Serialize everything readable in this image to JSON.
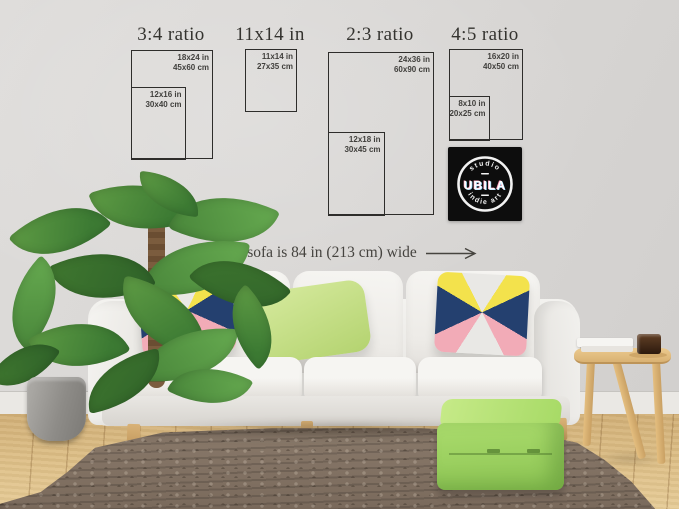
{
  "size_guide": {
    "sections": [
      {
        "title": "3:4 ratio",
        "frames": [
          {
            "size_in": "18x24 in",
            "size_cm": "45x60 cm"
          },
          {
            "size_in": "12x16 in",
            "size_cm": "30x40 cm"
          }
        ]
      },
      {
        "title": "11x14 in",
        "frames": [
          {
            "size_in": "11x14 in",
            "size_cm": "27x35 cm"
          }
        ]
      },
      {
        "title": "2:3 ratio",
        "frames": [
          {
            "size_in": "24x36 in",
            "size_cm": "60x90 cm"
          },
          {
            "size_in": "12x18 in",
            "size_cm": "30x45 cm"
          }
        ]
      },
      {
        "title": "4:5 ratio",
        "frames": [
          {
            "size_in": "16x20 in",
            "size_cm": "40x50 cm"
          },
          {
            "size_in": "8x10 in",
            "size_cm": "20x25 cm"
          }
        ]
      }
    ]
  },
  "dimension_label": "sofa is 84 in (213 cm) wide",
  "logo": {
    "top_text": "studio",
    "name": "UBILA",
    "bottom_text": "indie art"
  },
  "colors": {
    "wall": "#d9d7d5",
    "frame_border": "#2e2d2b",
    "text": "#34332f",
    "logo_bg": "#0d0d0d",
    "pillow_navy": "#24406f",
    "pillow_yellow": "#f3e24c",
    "pillow_pink": "#f2abb7",
    "pillow_green": "#c9e18b",
    "pouf_green": "#9fd45e",
    "rug": "#84756a",
    "floor_wood": "#dab97f",
    "table_wood": "#ddb273"
  }
}
